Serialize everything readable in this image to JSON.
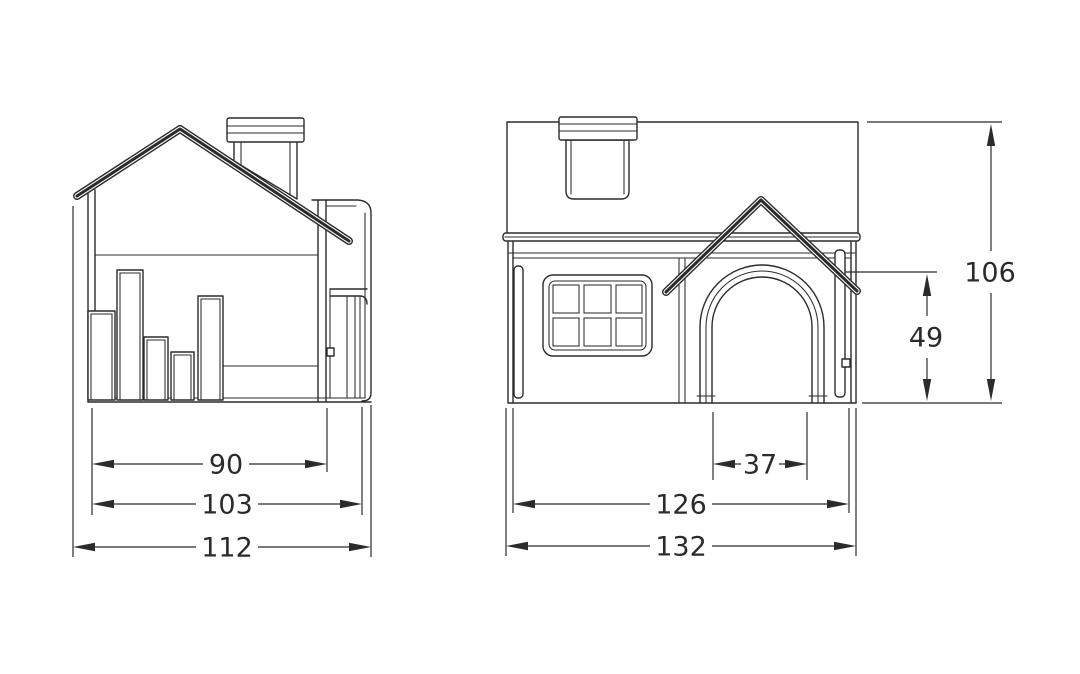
{
  "meta": {
    "background_color": "#ffffff",
    "line_color": "#2b2b2b",
    "text_color": "#2b2b2b",
    "drawing_type": "two-view dimensioned technical drawing of a small house-shaped product"
  },
  "views": {
    "side": {
      "dimensions": {
        "inner_width": {
          "value": "90"
        },
        "body_width": {
          "value": "103"
        },
        "overall_width": {
          "value": "112"
        }
      }
    },
    "front": {
      "dimensions": {
        "door_width": {
          "value": "37"
        },
        "body_width": {
          "value": "126"
        },
        "overall_width": {
          "value": "132"
        },
        "door_height": {
          "value": "49"
        },
        "overall_height": {
          "value": "106"
        }
      }
    }
  }
}
